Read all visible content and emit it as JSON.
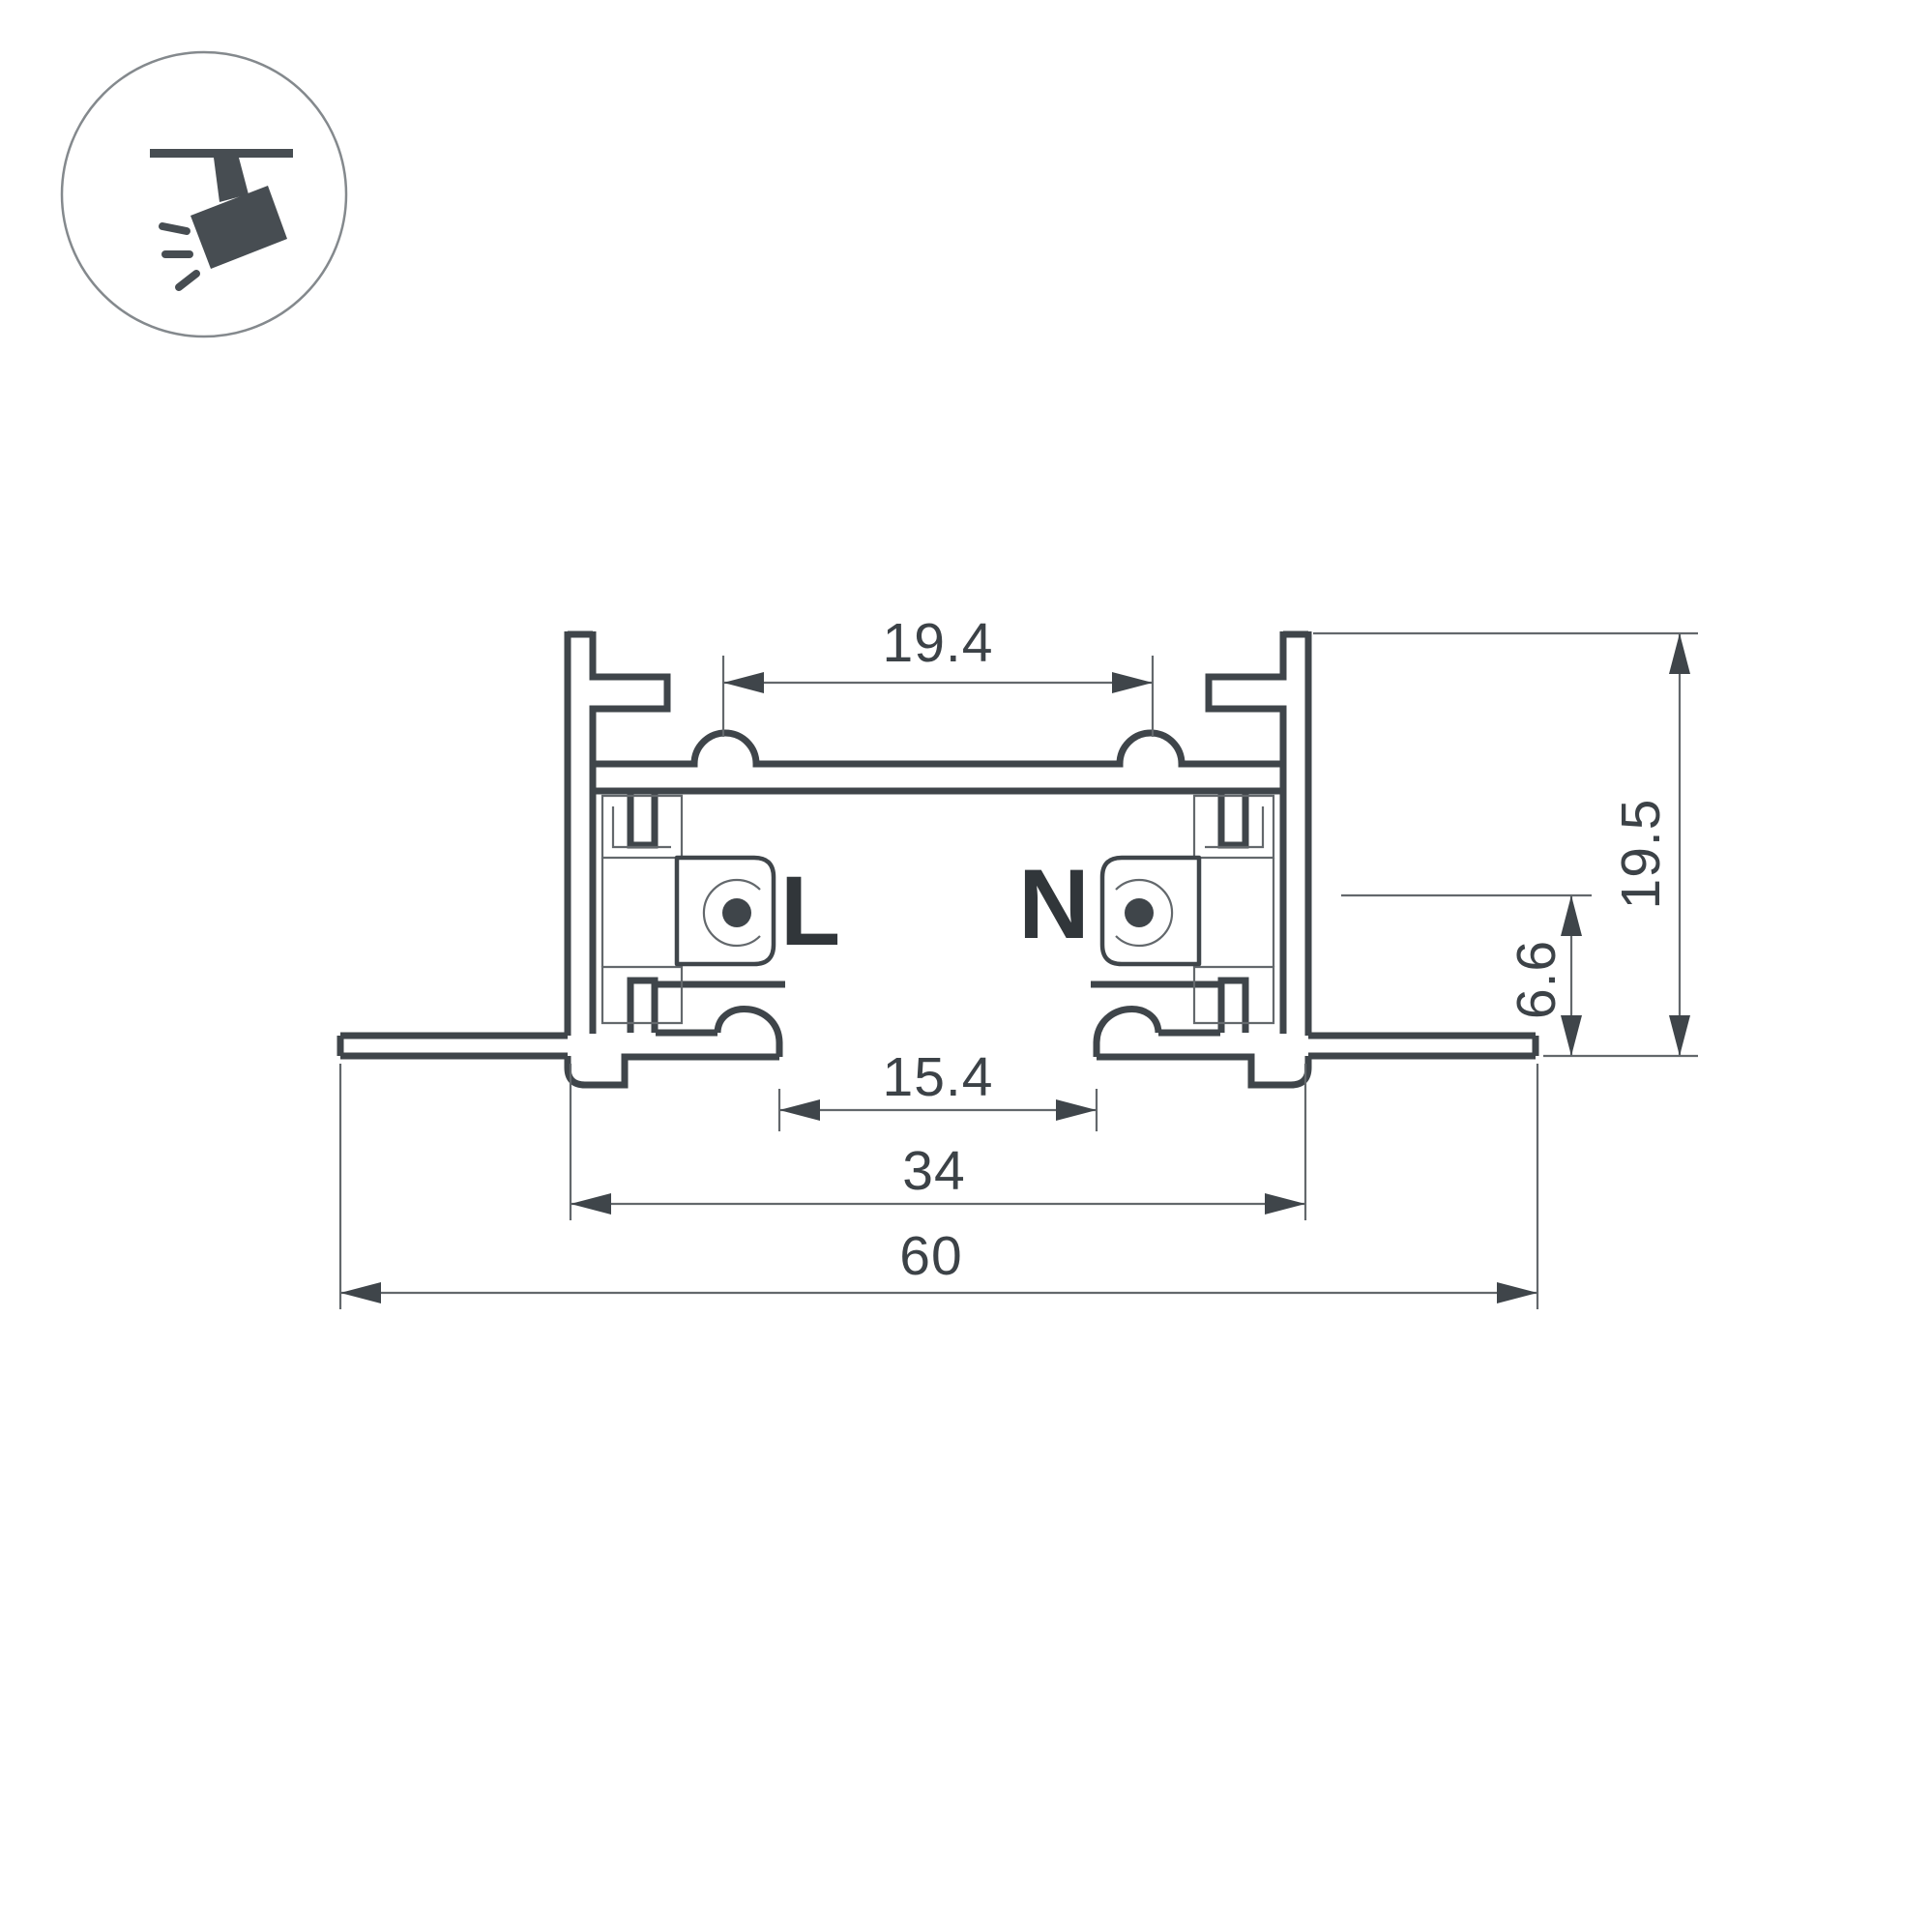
{
  "icon": {
    "name": "track-spotlight-icon"
  },
  "labels": {
    "live": "L",
    "neutral": "N"
  },
  "dimensions": {
    "top_slot_width": "19.4",
    "overall_height": "19.5",
    "contact_center_height": "6.6",
    "bottom_opening_width": "15.4",
    "body_width": "34",
    "overall_width": "60"
  },
  "colors": {
    "background": "#ffffff",
    "outline": "#3f454a",
    "thin_line": "#63686c",
    "text": "#3c4247",
    "icon": "#474d52"
  }
}
